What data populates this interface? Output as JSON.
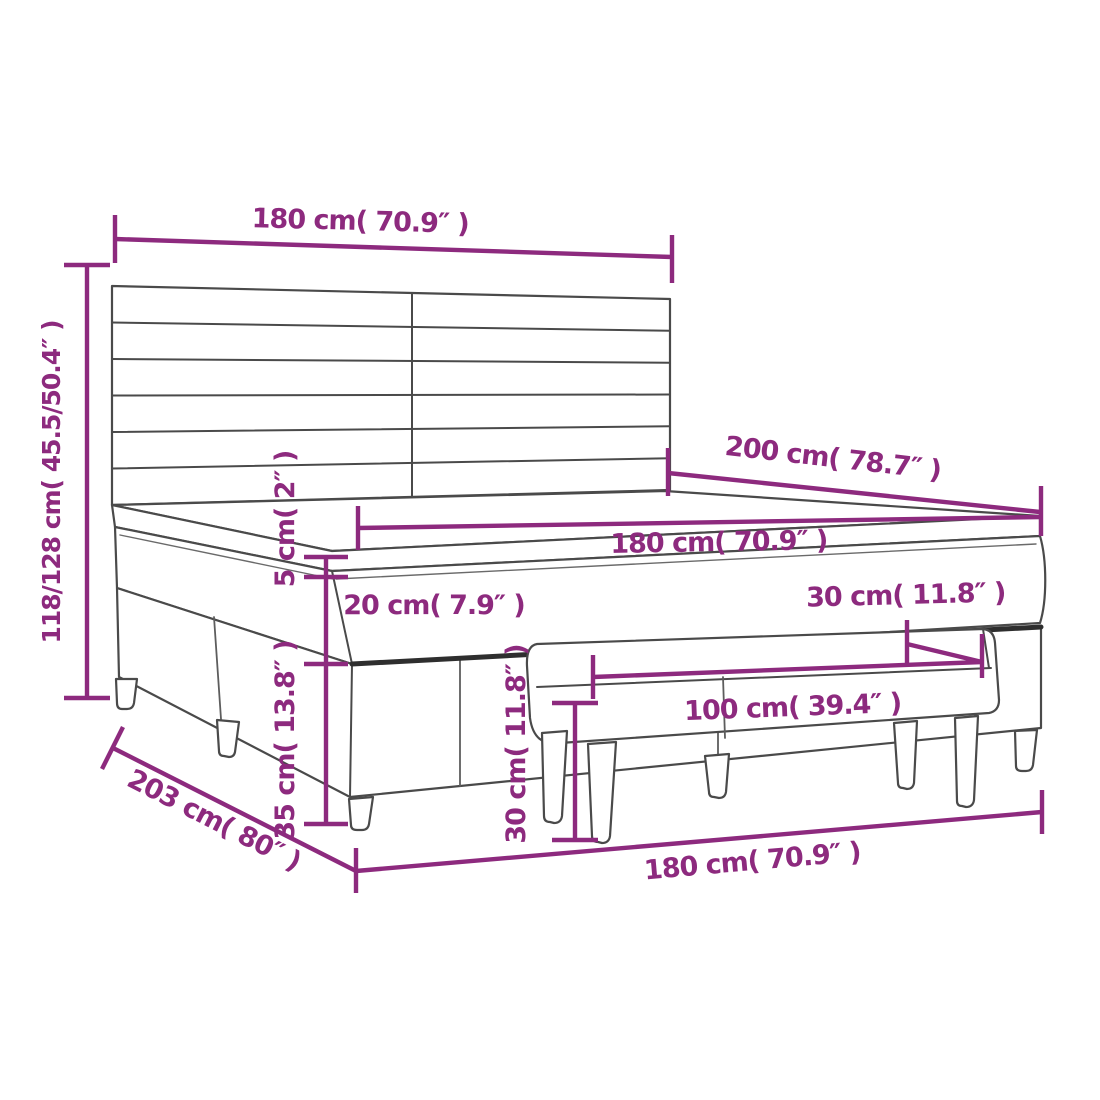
{
  "title": "Box spring bed with headboard and bench - dimension diagram",
  "colors": {
    "dimension_accent": "#8d2a7e",
    "drawing_outline": "#4a4a4a",
    "drawing_dark_edge": "#2e2e2e",
    "background": "#ffffff"
  },
  "dimensions": [
    {
      "id": "headboard_width",
      "label": "180 cm( 70.9″ )",
      "cm": "180",
      "inches": "70.9"
    },
    {
      "id": "total_height",
      "label": "118/128 cm( 45.5/50.4″ )",
      "cm": "118/128",
      "inches": "45.5/50.4"
    },
    {
      "id": "bed_length",
      "label": "200 cm( 78.7″ )",
      "cm": "200",
      "inches": "78.7"
    },
    {
      "id": "mattress_width",
      "label": "180 cm( 70.9″ )",
      "cm": "180",
      "inches": "70.9"
    },
    {
      "id": "topper_thickness",
      "label": "5 cm( 2″ )",
      "cm": "5",
      "inches": "2"
    },
    {
      "id": "mattress_thickness",
      "label": "20 cm( 7.9″ )",
      "cm": "20",
      "inches": "7.9"
    },
    {
      "id": "bench_depth",
      "label": "30 cm( 11.8″ )",
      "cm": "30",
      "inches": "11.8"
    },
    {
      "id": "base_height",
      "label": "35 cm( 13.8″ )",
      "cm": "35",
      "inches": "13.8"
    },
    {
      "id": "bench_height",
      "label": "30 cm( 11.8″ )",
      "cm": "30",
      "inches": "11.8"
    },
    {
      "id": "bench_width",
      "label": "100 cm( 39.4″ )",
      "cm": "100",
      "inches": "39.4"
    },
    {
      "id": "bed_depth",
      "label": "203 cm( 80″ )",
      "cm": "203",
      "inches": "80"
    },
    {
      "id": "bed_width_floor",
      "label": "180 cm( 70.9″ )",
      "cm": "180",
      "inches": "70.9"
    }
  ]
}
